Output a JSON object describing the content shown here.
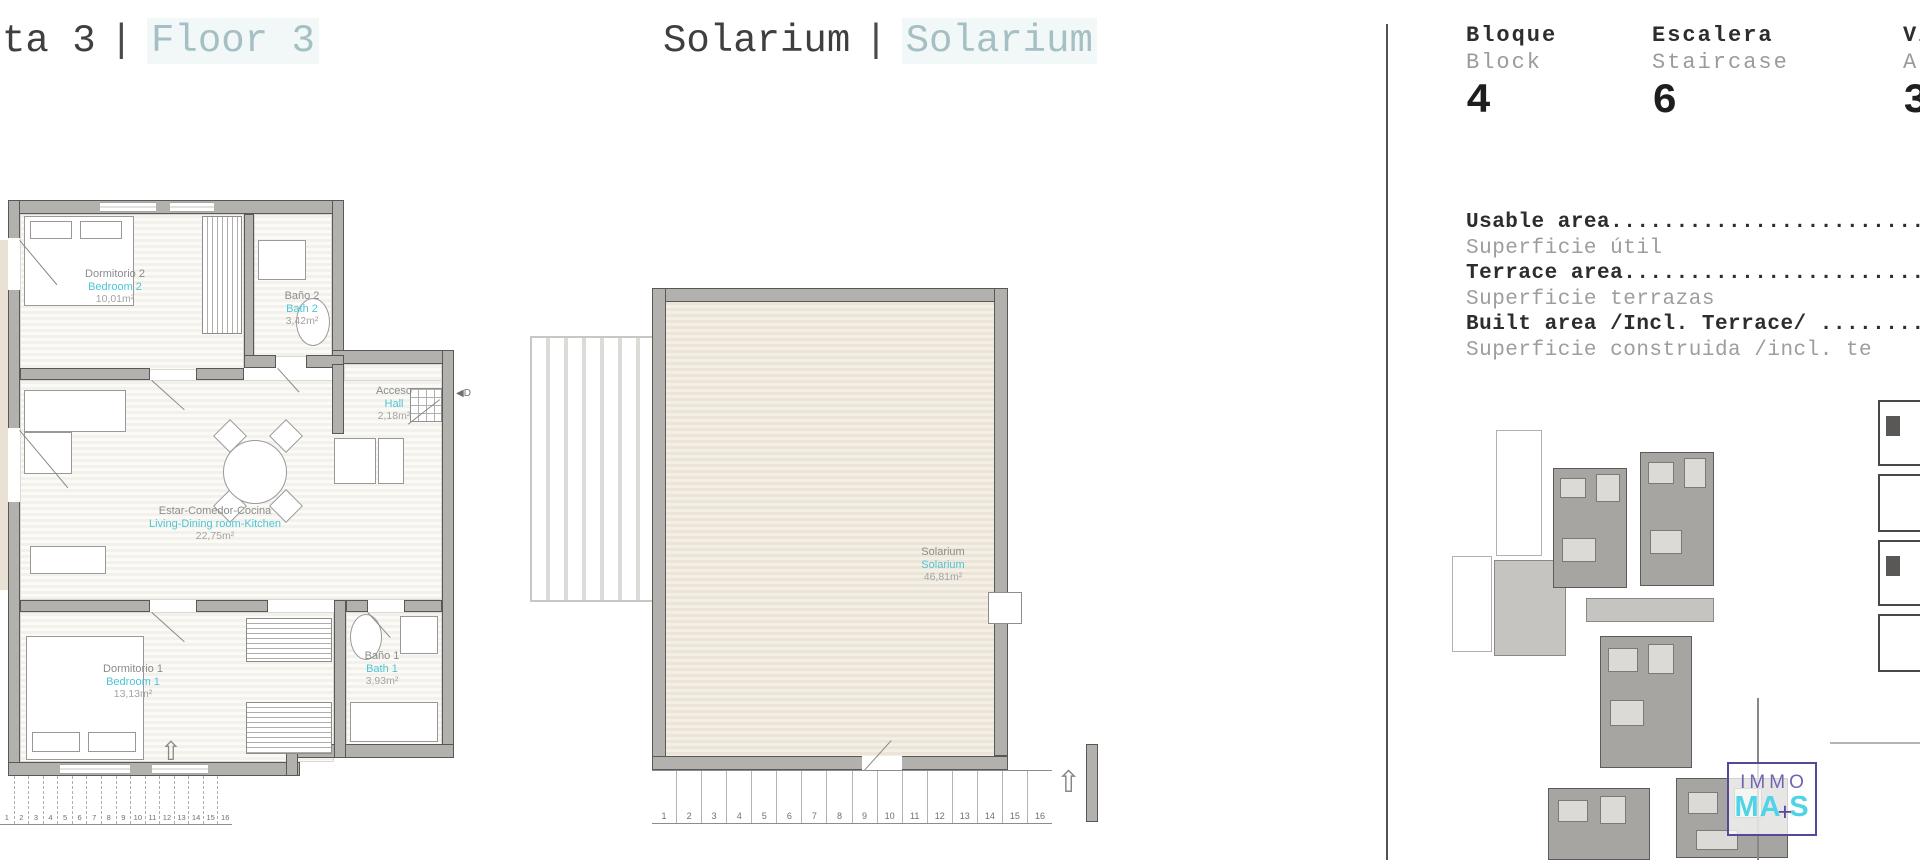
{
  "colors": {
    "teal": "#4cc5d6",
    "title_muted": "#a5c0c4",
    "logo_purple": "#55489a",
    "logo_cyan": "#4fd3e7"
  },
  "header": {
    "left_title": {
      "dark": "ta 3",
      "sep": "|",
      "light": "Floor 3"
    },
    "center_title": {
      "dark": "Solarium",
      "sep": "|",
      "light": "Solarium"
    }
  },
  "info_panel": {
    "columns": [
      {
        "es": "Bloque",
        "en": "Block",
        "value": "4"
      },
      {
        "es": "Escalera",
        "en": "Staircase",
        "value": "6"
      },
      {
        "es": "Viv",
        "en": "Apa",
        "value": "3D"
      }
    ],
    "areas": [
      {
        "en": "Usable area.................................",
        "es": "Superficie útil"
      },
      {
        "en": "Terrace area................................",
        "es": "Superficie terrazas"
      },
      {
        "en": "Built area /Incl. Terrace/ .................",
        "es": "Superficie construida /incl. te"
      }
    ]
  },
  "floorplan": {
    "rooms": [
      {
        "es": "Dormitorio 2",
        "en": "Bedroom 2",
        "area": "10,01m²"
      },
      {
        "es": "Baño 2",
        "en": "Bath 2",
        "area": "3,42m²"
      },
      {
        "es": "Acceso",
        "en": "Hall",
        "area": "2,18m²"
      },
      {
        "es": "Estar-Comedor-Cocina",
        "en": "Living-Dining room-Kitchen",
        "area": "22,75m²"
      },
      {
        "es": "Dormitorio 1",
        "en": "Bedroom 1",
        "area": "13,13m²"
      },
      {
        "es": "Baño 1",
        "en": "Bath 1",
        "area": "3,93m²"
      }
    ],
    "door_marker": "◀D",
    "stair_arrow": "⇧"
  },
  "solarium": {
    "label": {
      "es": "Solarium",
      "en": "Solarium",
      "area": "46,81m²"
    }
  },
  "stair_numbers": [
    "1",
    "2",
    "3",
    "4",
    "5",
    "6",
    "7",
    "8",
    "9",
    "10",
    "11",
    "12",
    "13",
    "14",
    "15",
    "16"
  ],
  "logo": {
    "top": "IMMO",
    "ma": "MA",
    "plus": "+",
    "s": "S"
  }
}
